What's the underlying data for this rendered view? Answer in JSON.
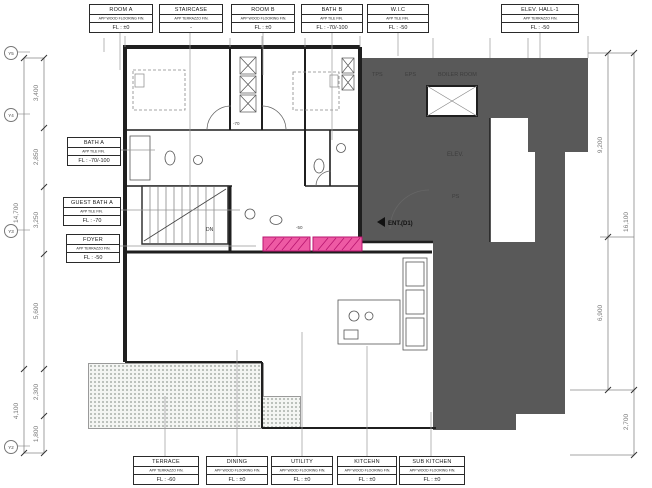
{
  "drawing": {
    "type": "architectural floor plan",
    "colors": {
      "wall_line": "#1f1f1f",
      "core_poche": "#595959",
      "highlight_pink": "#ee5aa4",
      "dimension_text": "#787878"
    }
  },
  "labels": {
    "top": [
      {
        "name": "ROOM A",
        "finish": "APP WOOD FLOORING FIN.",
        "level": "FL : ±0"
      },
      {
        "name": "STAIRCASE",
        "finish": "APP TERRAZZO FIN.",
        "level": "-"
      },
      {
        "name": "ROOM B",
        "finish": "APP WOOD FLOORING FIN.",
        "level": "FL : ±0"
      },
      {
        "name": "BATH B",
        "finish": "APP TILE FIN.",
        "level": "FL : -70/-100"
      },
      {
        "name": "W.I.C",
        "finish": "APP TILE FIN.",
        "level": "FL : -50"
      },
      {
        "name": "ELEV. HALL-1",
        "finish": "APP TERRAZZO FIN.",
        "level": "FL : -50"
      }
    ],
    "left": [
      {
        "name": "BATH A",
        "finish": "APP TILE FIN.",
        "level": "FL : -70/-100"
      },
      {
        "name": "GUEST BATH A",
        "finish": "APP TILE FIN.",
        "level": "FL : -70"
      },
      {
        "name": "FOYER",
        "finish": "APP TERRAZZO FIN.",
        "level": "FL : -50"
      }
    ],
    "bottom": [
      {
        "name": "TERRACE",
        "finish": "APP TERRAZZO FIN.",
        "level": "FL : -60"
      },
      {
        "name": "DINING",
        "finish": "APP WOOD FLOORING FIN.",
        "level": "FL : ±0"
      },
      {
        "name": "UTILITY",
        "finish": "APP WOOD FLOORING FIN.",
        "level": "FL : ±0"
      },
      {
        "name": "KITCEHN",
        "finish": "APP WOOD FLOORING FIN.",
        "level": "FL : ±0"
      },
      {
        "name": "SUB KITCHEN",
        "finish": "APP WOOD FLOORING FIN.",
        "level": "FL : ±0"
      }
    ]
  },
  "plan": {
    "tps": "TPS",
    "eps": "EPS",
    "boiler": "BOILER ROOM",
    "elev": "ELEV.",
    "ps": "PS",
    "ent": "ENT.(D1)",
    "dn": "DN",
    "note_minus70": "-70",
    "note_minus50": "-50"
  },
  "dims": {
    "left": [
      "3,400",
      "2,850",
      "3,250",
      "5,600",
      "2,300",
      "1,800"
    ],
    "left_totals": [
      "14,700",
      "4,100"
    ],
    "right": [
      "9,200",
      "6,900",
      "2,700"
    ],
    "right_totals": [
      "16,100"
    ],
    "bubbles": [
      "Y5",
      "Y4",
      "Y3",
      "Y2"
    ]
  }
}
